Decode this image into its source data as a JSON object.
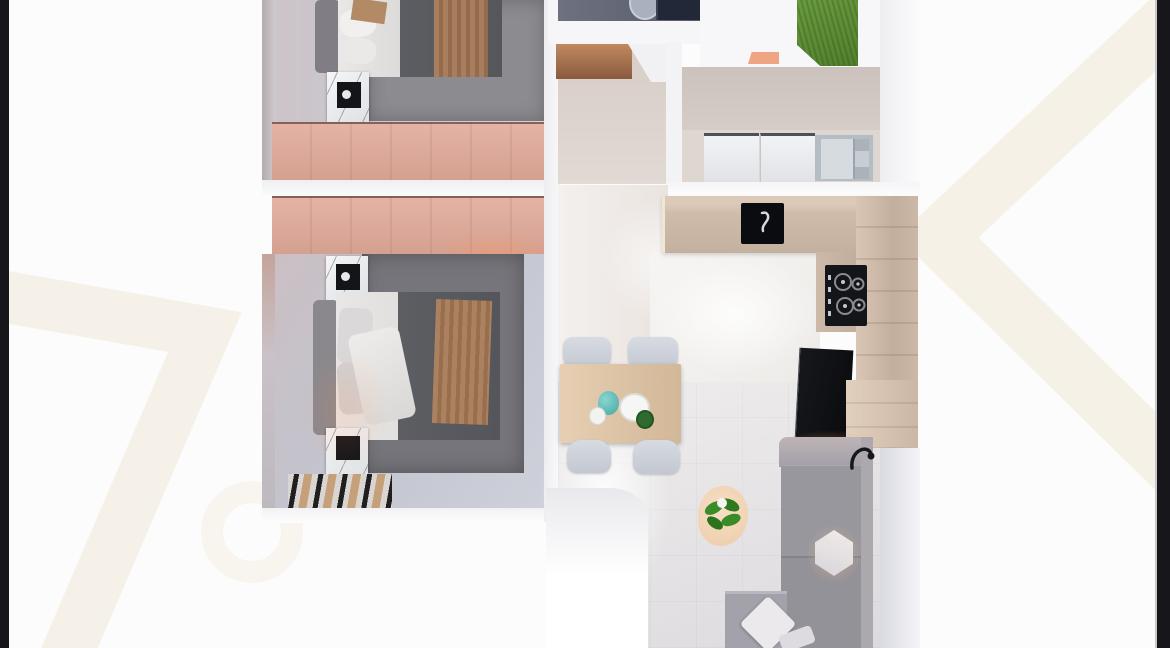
{
  "palette": {
    "bg_page": "#fcfcfc",
    "bar_dark": "#17171b",
    "watermark": "#f4eee1",
    "rug_mid": "#8b8b90",
    "rug_dark": "#75757b",
    "bench_salmon": "#efa584",
    "grass_green": "#5f8f38",
    "counter_wood": "#d0bcab",
    "wardrobe_wood": "#d8a89a",
    "sofa_gray": "#98979e",
    "stove_black": "#141519",
    "sink_black": "#0b0c0f",
    "teal_accent": "#46a6a2",
    "plant_green": "#3a8c28"
  },
  "scene": {
    "type": "3d-floor-plan-top-down-render",
    "rooms": [
      {
        "name": "bedroom-top",
        "furniture": [
          "double-bed",
          "brown-blanket",
          "marble-nightstand",
          "wardrobe-band",
          "gray-rug"
        ]
      },
      {
        "name": "bedroom-bottom",
        "furniture": [
          "double-bed",
          "brown-blanket",
          "marble-nightstand-upper",
          "marble-nightstand-lower",
          "wardrobe-band",
          "gray-rug",
          "striped-mat"
        ]
      },
      {
        "name": "bathroom",
        "furniture": [
          "round-basin",
          "dark-shower"
        ]
      },
      {
        "name": "hallway",
        "furniture": [
          "wood-wardrobe"
        ]
      },
      {
        "name": "patio",
        "furniture": [
          "grass-lawn",
          "salmon-bench"
        ]
      },
      {
        "name": "laundry",
        "furniture": [
          "washer-left",
          "washer-right",
          "gray-shelf-cabinet"
        ]
      },
      {
        "name": "kitchen",
        "furniture": [
          "l-shaped-wood-counter",
          "black-sink",
          "gas-stove-4-burners",
          "tv",
          "tv-cabinet"
        ]
      },
      {
        "name": "dining",
        "furniture": [
          "wood-table",
          "chair-top-left",
          "chair-top-right",
          "chair-bottom-left",
          "chair-bottom-right",
          "teal-vase",
          "white-dishes",
          "green-bottle"
        ]
      },
      {
        "name": "living",
        "furniture": [
          "corner-sofa",
          "hexagon-cushion",
          "diamond-pillows",
          "plant-on-round-rug",
          "black-floor-lamp"
        ]
      }
    ],
    "background": [
      "black-edge-bar-left",
      "black-edge-bar-right",
      "cream-chevron-watermark-left",
      "cream-chevron-watermark-right"
    ]
  }
}
